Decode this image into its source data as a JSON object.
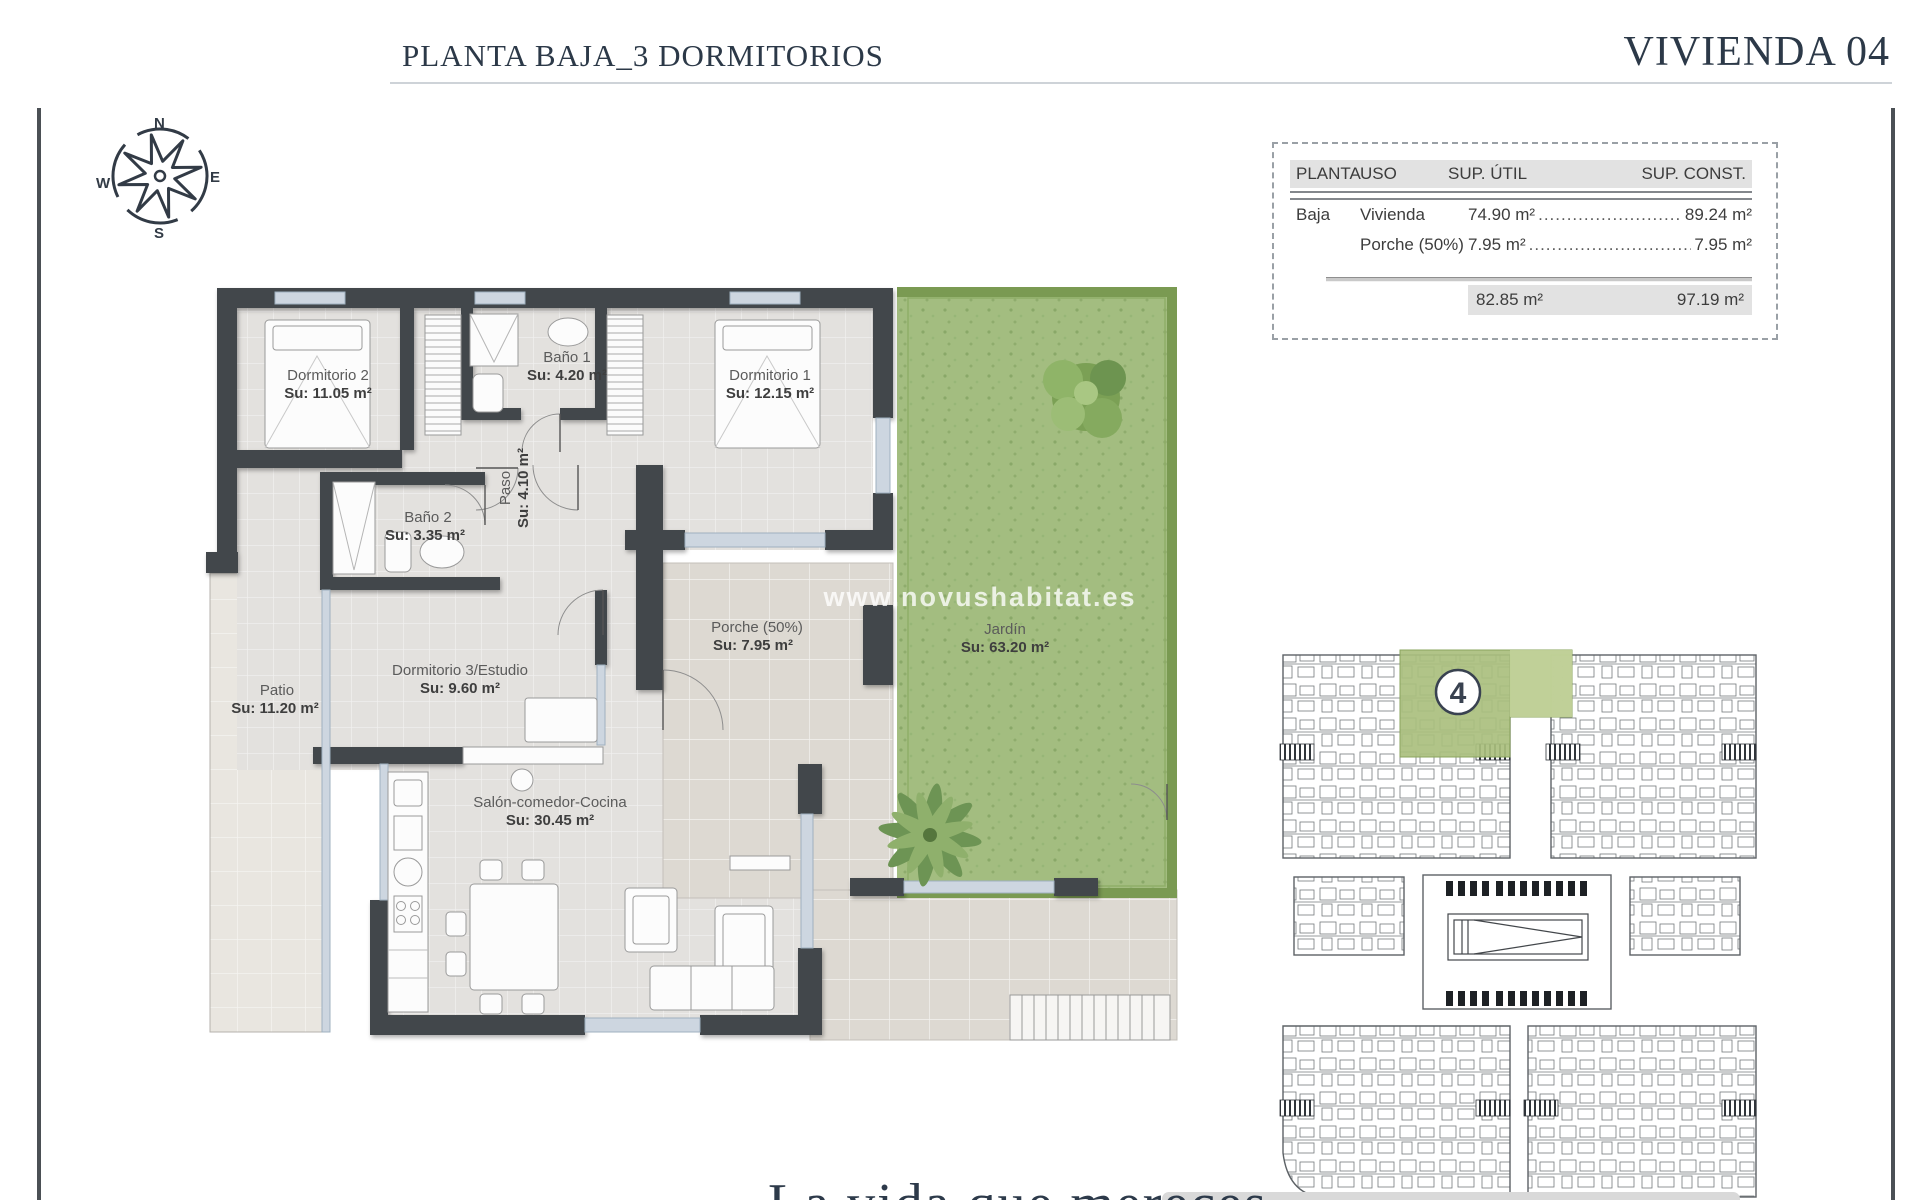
{
  "page": {
    "title_left": "PLANTA BAJA_3 DORMITORIOS",
    "title_right": "VIVIENDA 04",
    "tagline": "La vida que mereces",
    "watermark": "www.novushabitat.es"
  },
  "compass": {
    "n": "N",
    "e": "E",
    "s": "S",
    "w": "W"
  },
  "area_table": {
    "headers": {
      "planta": "PLANTA",
      "uso": "USO",
      "util": "SUP. ÚTIL",
      "const": "SUP. CONST."
    },
    "rows": [
      {
        "planta": "Baja",
        "uso": "Vivienda",
        "util": "74.90 m²",
        "leader": "......................................",
        "const": "89.24 m²"
      },
      {
        "planta": "",
        "uso": "Porche (50%)",
        "util": "7.95 m²",
        "leader": "......................................",
        "const": "7.95 m²"
      }
    ],
    "totals": {
      "util": "82.85 m²",
      "const": "97.19 m²"
    }
  },
  "rooms": {
    "dormitorio2": {
      "name": "Dormitorio 2",
      "area": "Su: 11.05 m²"
    },
    "bano1": {
      "name": "Baño 1",
      "area": "Su: 4.20 m²"
    },
    "dormitorio1": {
      "name": "Dormitorio 1",
      "area": "Su: 12.15 m²"
    },
    "bano2": {
      "name": "Baño 2",
      "area": "Su: 3.35 m²"
    },
    "paso": {
      "name": "Paso",
      "area": "Su: 4.10 m²"
    },
    "patio": {
      "name": "Patio",
      "area": "Su: 11.20 m²"
    },
    "dormitorio3": {
      "name": "Dormitorio 3/Estudio",
      "area": "Su: 9.60 m²"
    },
    "porche": {
      "name": "Porche (50%)",
      "area": "Su: 7.95 m²"
    },
    "jardin": {
      "name": "Jardín",
      "area": "Su: 63.20 m²"
    },
    "salon": {
      "name": "Salón-comedor-Cocina",
      "area": "Su: 30.45 m²"
    }
  },
  "site_plan": {
    "unit_number": "4",
    "highlight_color": "#aabf7e"
  },
  "colors": {
    "wall": "#43474b",
    "navy": "#2c3948",
    "grass": "#a3bd80",
    "hedge": "#7a9a52",
    "glass": "#cdd6e0",
    "floor": "#e3e1de",
    "terrace": "#ddd9d2"
  }
}
